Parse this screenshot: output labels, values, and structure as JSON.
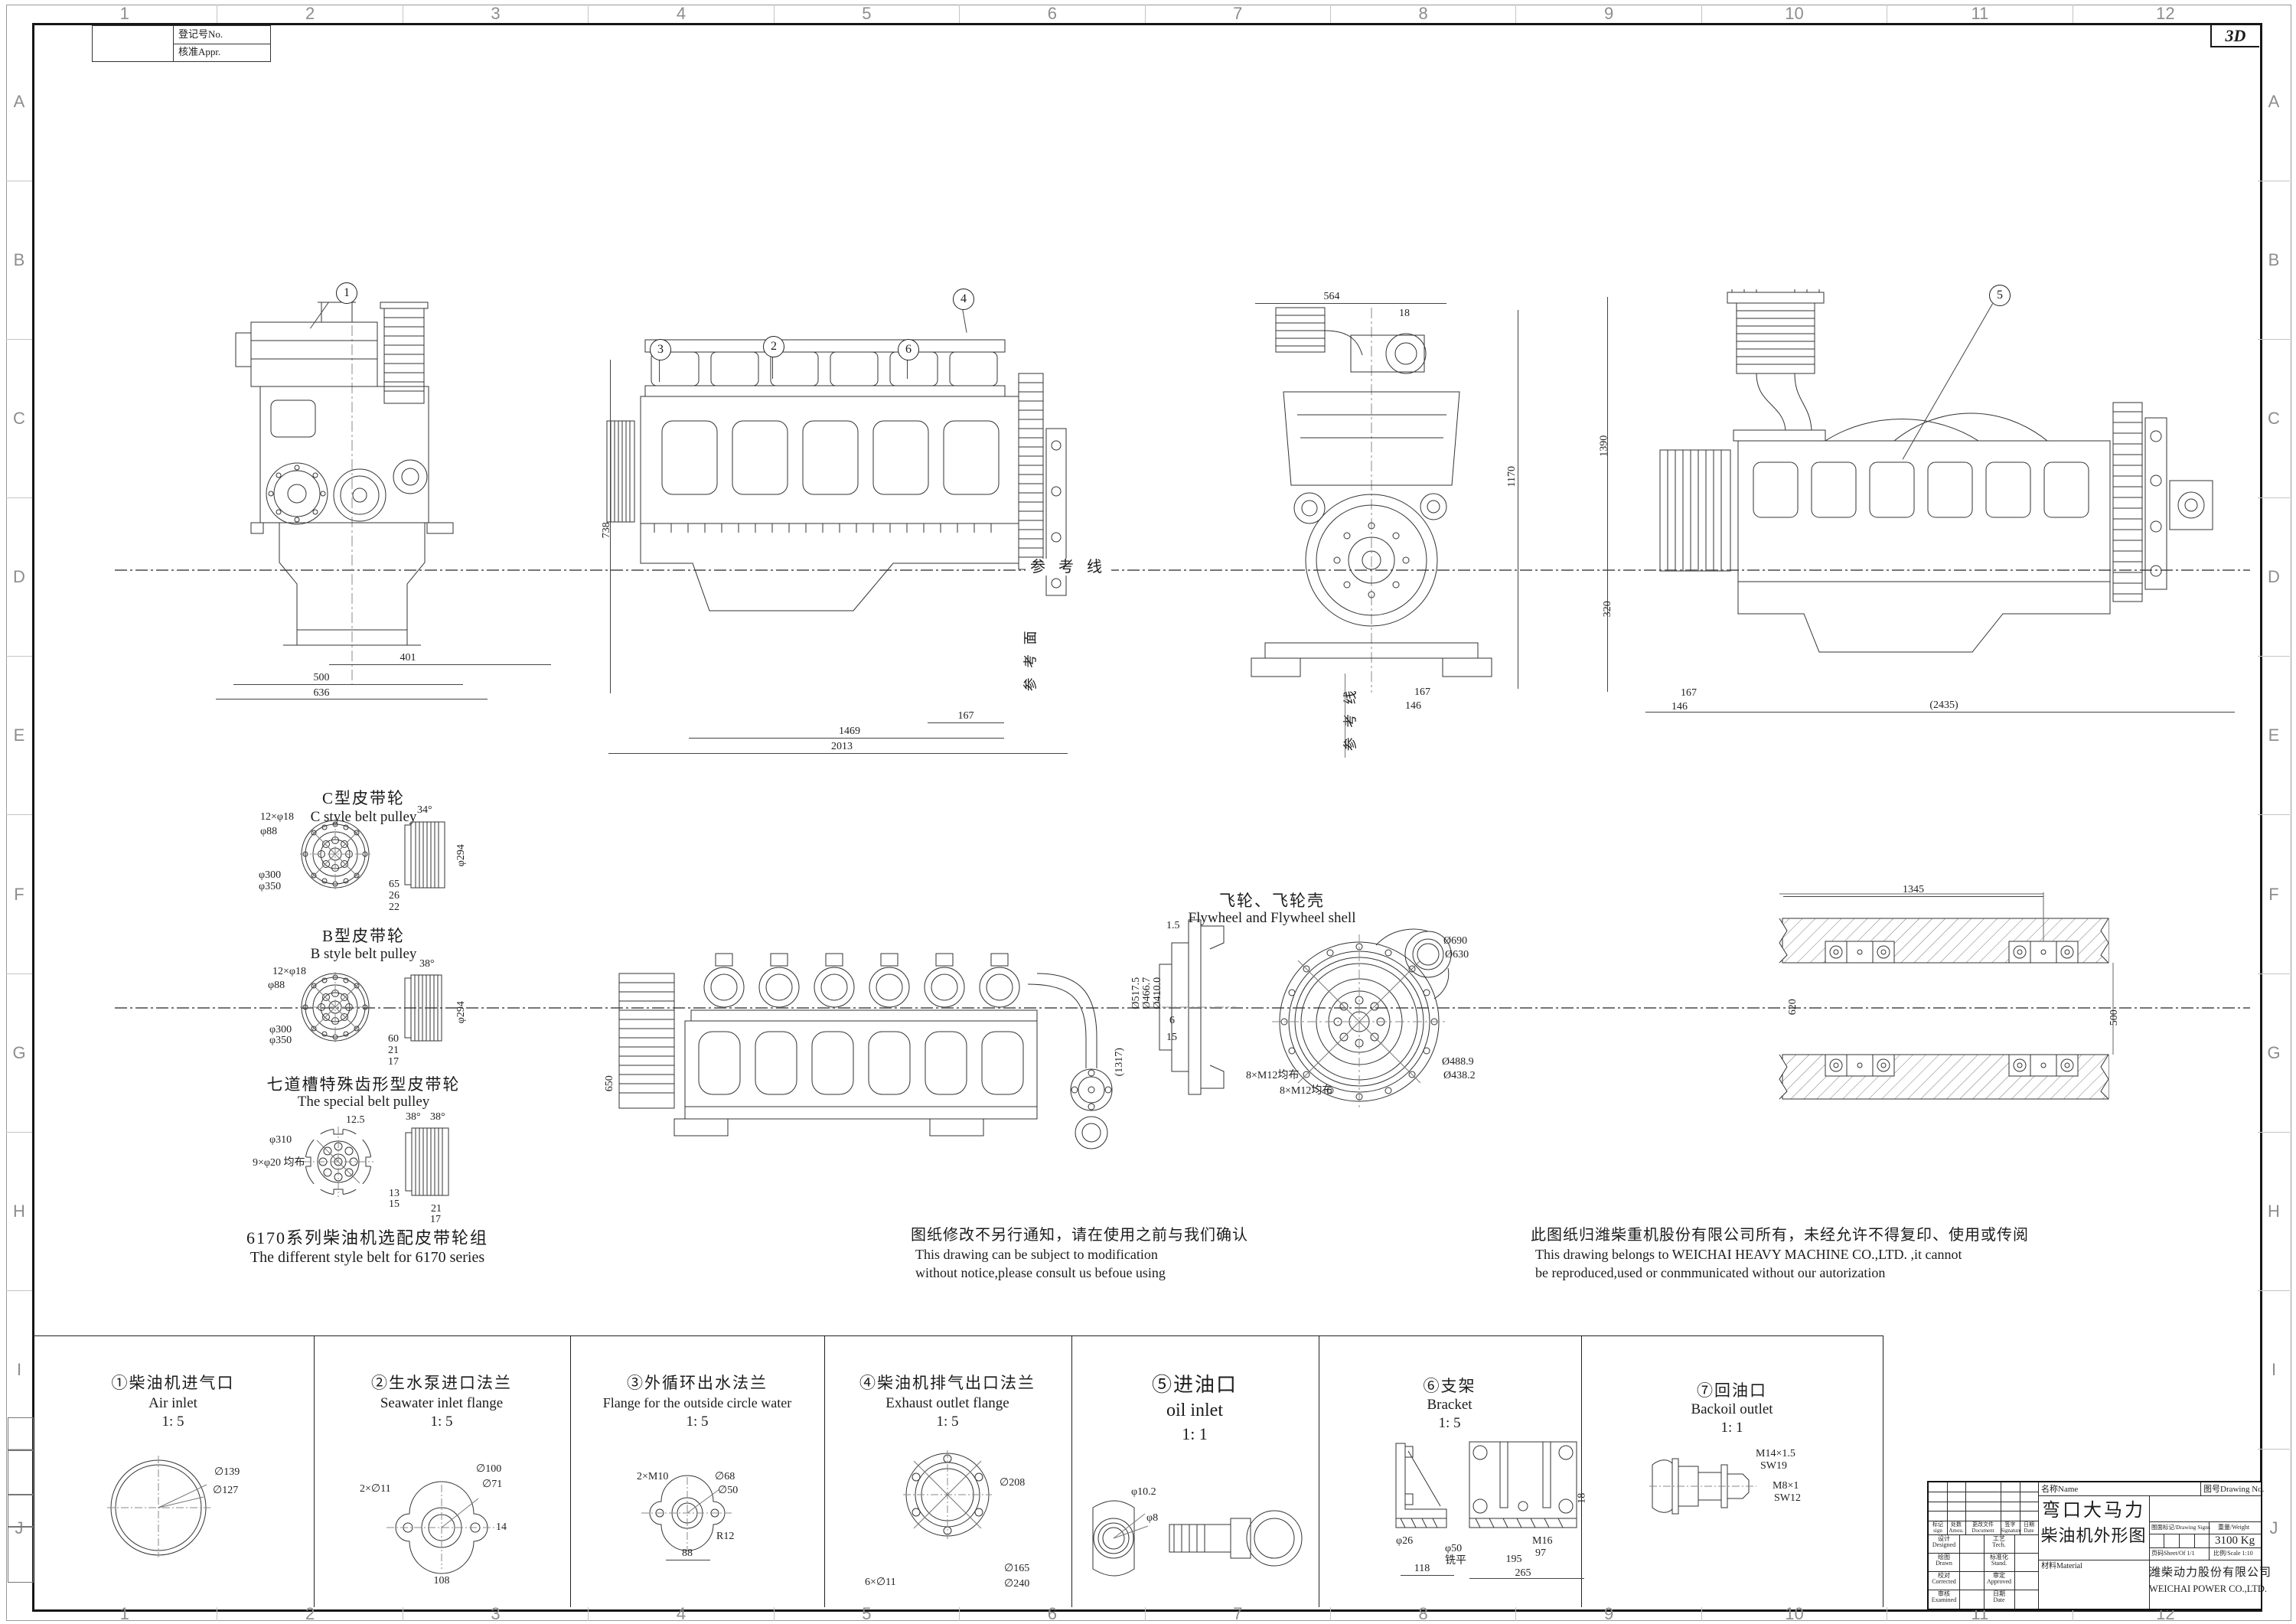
{
  "sheet": {
    "marker_3d": "3D"
  },
  "grid": {
    "cols": [
      "1",
      "2",
      "3",
      "4",
      "5",
      "6",
      "7",
      "8",
      "9",
      "10",
      "11",
      "12"
    ],
    "rows": [
      "A",
      "B",
      "C",
      "D",
      "E",
      "F",
      "G",
      "H",
      "I",
      "J"
    ]
  },
  "registration": {
    "no_label": "登记号No.",
    "appr_label": "核准Appr."
  },
  "balloons": {
    "front": "1",
    "side_turbo": "3",
    "side_pump": "2",
    "side_bracket": "6",
    "side_exhaust": "4",
    "right_oil": "5"
  },
  "views": {
    "front": {
      "dims": [
        "401",
        "500",
        "636"
      ]
    },
    "side": {
      "dims": [
        "738",
        "167",
        "1469",
        "2013"
      ],
      "ref_line": "参 考 线",
      "ref_plane": "参 考 面"
    },
    "rear": {
      "dims": [
        "564",
        "18",
        "1170",
        "167",
        "146"
      ],
      "ref_line": "参 考 线"
    },
    "right": {
      "dims": [
        "1390",
        "320",
        "167",
        "146",
        "(2435)"
      ]
    },
    "bottom": {
      "dims": [
        "650",
        "(1317)"
      ]
    },
    "shaft": {
      "dims": [
        "1345",
        "620",
        "500"
      ]
    }
  },
  "pulleys": {
    "c": {
      "title_cn": "C型皮带轮",
      "title_en": "C style belt pulley",
      "front_dims": [
        "12×φ18",
        "φ88",
        "φ300",
        "φ350"
      ],
      "side_dims": [
        "34°",
        "φ294",
        "65",
        "26",
        "22"
      ]
    },
    "b": {
      "title_cn": "B型皮带轮",
      "title_en": "B style belt pulley",
      "front_dims": [
        "12×φ18",
        "φ88",
        "φ300",
        "φ350"
      ],
      "side_dims": [
        "38°",
        "φ294",
        "60",
        "21",
        "17"
      ]
    },
    "special": {
      "title_cn": "七道槽特殊齿形型皮带轮",
      "title_en": "The special belt pulley",
      "front_dims": [
        "12.5",
        "φ310",
        "9×φ20 均布"
      ],
      "side_dims": [
        "38°",
        "38°",
        "13",
        "15",
        "21",
        "17"
      ]
    },
    "footer_cn": "6170系列柴油机选配皮带轮组",
    "footer_en": "The different style belt for 6170 series"
  },
  "flywheel": {
    "title_cn": "飞轮、飞轮壳",
    "title_en": "Flywheel and Flywheel shell",
    "section_dims": [
      "1.5",
      "Ø517.5",
      "Ø466.7",
      "Ø410.0",
      "6",
      "15"
    ],
    "front_dims": [
      "Ø690",
      "Ø630",
      "Ø488.9",
      "Ø438.2",
      "8×M12均布",
      "8×M12均布"
    ]
  },
  "notes": {
    "modification": {
      "cn": "图纸修改不另行通知，请在使用之前与我们确认",
      "en1": "This drawing can be subject to modification",
      "en2": "without notice,please consult us befoue using"
    },
    "ownership": {
      "cn": "此图纸归潍柴重机股份有限公司所有，未经允许不得复印、使用或传阅",
      "en1": "This drawing belongs to WEICHAI HEAVY MACHINE CO.,LTD. ,it cannot",
      "en2": "be reproduced,used or conmmunicated without our autorization"
    }
  },
  "details": [
    {
      "title_cn": "①柴油机进气口",
      "title_en": "Air inlet",
      "scale": "1: 5",
      "dims": [
        "∅139",
        "∅127"
      ]
    },
    {
      "title_cn": "②生水泵进口法兰",
      "title_en": "Seawater inlet flange",
      "scale": "1: 5",
      "dims": [
        "∅100",
        "∅71",
        "2×∅11",
        "14",
        "108"
      ]
    },
    {
      "title_cn": "③外循环出水法兰",
      "title_en": "Flange for the outside circle water",
      "scale": "1: 5",
      "dims": [
        "2×M10",
        "∅68",
        "∅50",
        "R12",
        "88"
      ]
    },
    {
      "title_cn": "④柴油机排气出口法兰",
      "title_en": "Exhaust outlet flange",
      "scale": "1: 5",
      "dims": [
        "∅208",
        "∅165",
        "6×∅11",
        "∅240"
      ]
    },
    {
      "title_cn": "⑤进油口",
      "title_en": "oil inlet",
      "scale": "1: 1",
      "dims": [
        "φ10.2",
        "φ8"
      ]
    },
    {
      "title_cn": "⑥支架",
      "title_en": "Bracket",
      "scale": "1: 5",
      "dims": [
        "φ26",
        "118",
        "φ50",
        "铣平",
        "M16",
        "97",
        "195",
        "265",
        "18"
      ]
    },
    {
      "title_cn": "⑦回油口",
      "title_en": "Backoil outlet",
      "scale": "1: 1",
      "dims": [
        "M14×1.5",
        "SW19",
        "M8×1",
        "SW12"
      ]
    }
  ],
  "title_block": {
    "name_label": "名称Name",
    "drawing_no_label": "图号Drawing No.",
    "name_line1": "弯口大马力",
    "name_line2": "柴油机外形图",
    "signs_label": "图面标记/Drawing Signs",
    "weight_label": "重量/Weight",
    "weight_value": "3100 Kg",
    "sheet_label": "页码Sheet/Of 1/1",
    "scale_label": "比例/Scale 1:10",
    "material_label": "材料Material",
    "company_cn": "潍柴动力股份有限公司",
    "company_en": "WEICHAI POWER CO.,LTD.",
    "rev_headers": [
      {
        "cn": "标记",
        "en": "sign"
      },
      {
        "cn": "处数",
        "en": "Amou."
      },
      {
        "cn": "更改文件",
        "en": "Document"
      },
      {
        "cn": "签字",
        "en": "Signature"
      },
      {
        "cn": "日期",
        "en": "Date"
      }
    ],
    "sign_rows": [
      {
        "l_cn": "设计",
        "l_en": "Designed",
        "r_cn": "工艺",
        "r_en": "Tech."
      },
      {
        "l_cn": "绘图",
        "l_en": "Drawn",
        "r_cn": "标准化",
        "r_en": "Stand."
      },
      {
        "l_cn": "校对",
        "l_en": "Corrected",
        "r_cn": "审定",
        "r_en": "Approved"
      },
      {
        "l_cn": "审核",
        "l_en": "Examined",
        "r_cn": "日期",
        "r_en": "Date"
      }
    ]
  }
}
